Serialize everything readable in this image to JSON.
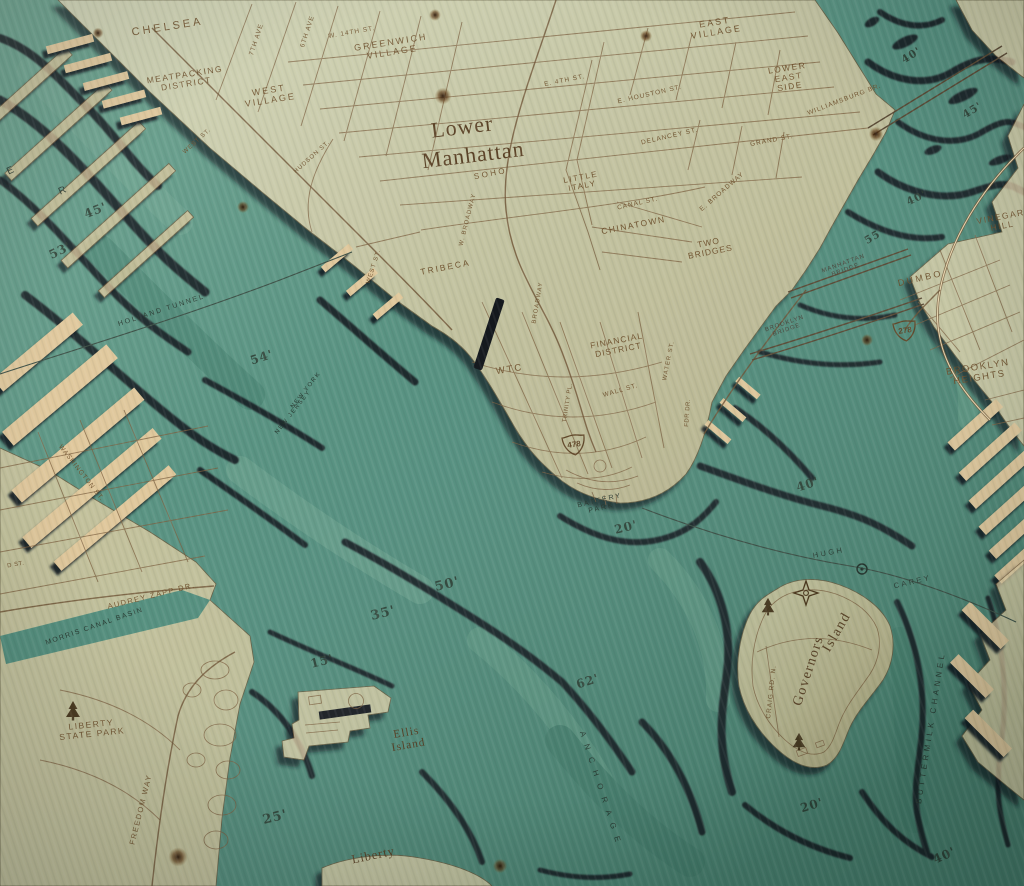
{
  "artwork": {
    "title": "Lower Manhattan",
    "subject": "3-D wood-carved nautical chart of Lower Manhattan and New York Harbor",
    "colors": {
      "wood_land": "#ead7ae",
      "water_teal": "#579181",
      "contour_shadow": "#131a20",
      "engraving": "#6b4c28"
    }
  },
  "shields": [
    {
      "id": "i478",
      "number": "478",
      "x": 574,
      "y": 444,
      "rot": -8
    },
    {
      "id": "i278",
      "number": "278",
      "x": 905,
      "y": 330,
      "rot": -8
    }
  ],
  "icons": [
    {
      "name": "tree-icon",
      "x": 73,
      "y": 710,
      "s": 1
    },
    {
      "name": "tree-icon",
      "x": 768,
      "y": 606,
      "s": 0.9
    },
    {
      "name": "tree-icon",
      "x": 799,
      "y": 741,
      "s": 0.9
    },
    {
      "name": "compass-star-icon",
      "x": 806,
      "y": 593,
      "s": 1
    },
    {
      "name": "tunnel-vent-icon",
      "x": 862,
      "y": 569,
      "s": 1
    },
    {
      "name": "wood-knot-icon",
      "x": 443,
      "y": 96,
      "s": 0.7
    },
    {
      "name": "wood-knot-icon",
      "x": 646,
      "y": 36,
      "s": 0.5
    },
    {
      "name": "wood-knot-icon",
      "x": 876,
      "y": 134,
      "s": 0.6
    },
    {
      "name": "wood-knot-icon",
      "x": 243,
      "y": 207,
      "s": 0.5
    },
    {
      "name": "wood-knot-icon",
      "x": 98,
      "y": 33,
      "s": 0.45
    },
    {
      "name": "wood-knot-icon",
      "x": 435,
      "y": 15,
      "s": 0.5
    },
    {
      "name": "wood-knot-icon",
      "x": 867,
      "y": 340,
      "s": 0.5
    },
    {
      "name": "wood-knot-icon",
      "x": 178,
      "y": 857,
      "s": 0.8
    },
    {
      "name": "wood-knot-icon",
      "x": 500,
      "y": 866,
      "s": 0.6
    }
  ],
  "labels": [
    {
      "id": "chelsea",
      "text": [
        "CHELSEA"
      ],
      "x": 168,
      "y": 30,
      "rot": -9,
      "size": 11,
      "sp": 3,
      "style": "land"
    },
    {
      "id": "seventh-ave",
      "text": [
        "7TH AVE"
      ],
      "x": 258,
      "y": 40,
      "rot": -72,
      "size": 6.5,
      "sp": 1,
      "style": "land"
    },
    {
      "id": "sixth-ave",
      "text": [
        "6TH AVE"
      ],
      "x": 309,
      "y": 32,
      "rot": -72,
      "size": 6.5,
      "sp": 1,
      "style": "land"
    },
    {
      "id": "w-14th-st",
      "text": [
        "W. 14TH ST."
      ],
      "x": 352,
      "y": 34,
      "rot": -10,
      "size": 6.5,
      "sp": 1,
      "style": "land"
    },
    {
      "id": "greenwich-village",
      "text": [
        "GREENWICH",
        "VILLAGE"
      ],
      "x": 392,
      "y": 50,
      "rot": -9,
      "size": 9,
      "sp": 2,
      "style": "land"
    },
    {
      "id": "meatpacking-district",
      "text": [
        "MEATPACKING",
        "DISTRICT"
      ],
      "x": 186,
      "y": 82,
      "rot": -9,
      "size": 8.5,
      "sp": 1.5,
      "style": "land"
    },
    {
      "id": "west-village",
      "text": [
        "WEST",
        "VILLAGE"
      ],
      "x": 270,
      "y": 98,
      "rot": -9,
      "size": 9,
      "sp": 2,
      "style": "land"
    },
    {
      "id": "east-village",
      "text": [
        "EAST",
        "VILLAGE"
      ],
      "x": 716,
      "y": 30,
      "rot": -9,
      "size": 9,
      "sp": 2,
      "style": "land"
    },
    {
      "id": "e-4th-st",
      "text": [
        "E. 4TH ST."
      ],
      "x": 565,
      "y": 82,
      "rot": -11,
      "size": 6.5,
      "sp": 1,
      "style": "land"
    },
    {
      "id": "e-houston-st",
      "text": [
        "E. HOUSTON ST."
      ],
      "x": 650,
      "y": 96,
      "rot": -13,
      "size": 6.5,
      "sp": 1,
      "style": "land"
    },
    {
      "id": "lower-east-side",
      "text": [
        "LOWER",
        "EAST",
        "SIDE"
      ],
      "x": 789,
      "y": 80,
      "rot": -9,
      "size": 8.5,
      "sp": 1.5,
      "style": "land"
    },
    {
      "id": "williamsburg-br",
      "text": [
        "WILLIAMSBURG BR."
      ],
      "x": 845,
      "y": 101,
      "rot": -21,
      "size": 6.5,
      "sp": 1,
      "style": "land"
    },
    {
      "id": "delancey-st",
      "text": [
        "DELANCEY ST."
      ],
      "x": 670,
      "y": 138,
      "rot": -13,
      "size": 6.5,
      "sp": 1,
      "style": "land"
    },
    {
      "id": "grand-st",
      "text": [
        "GRAND ST."
      ],
      "x": 772,
      "y": 142,
      "rot": -11,
      "size": 6.5,
      "sp": 1,
      "style": "land"
    },
    {
      "id": "west-st-upper",
      "text": [
        "WEST ST."
      ],
      "x": 198,
      "y": 142,
      "rot": -42,
      "size": 6,
      "sp": 1,
      "style": "land"
    },
    {
      "id": "hudson-st",
      "text": [
        "HUDSON ST."
      ],
      "x": 313,
      "y": 158,
      "rot": -42,
      "size": 6,
      "sp": 1,
      "style": "land"
    },
    {
      "id": "title-lower",
      "text": [
        "Lower"
      ],
      "x": 463,
      "y": 134,
      "rot": -7,
      "size": 22,
      "sp": 1,
      "style": "serif"
    },
    {
      "id": "title-manhattan",
      "text": [
        "Manhattan"
      ],
      "x": 474,
      "y": 162,
      "rot": -7,
      "size": 22,
      "sp": 1,
      "style": "serif"
    },
    {
      "id": "soho",
      "text": [
        "SOHO"
      ],
      "x": 491,
      "y": 176,
      "rot": -11,
      "size": 8,
      "sp": 2.5,
      "style": "land"
    },
    {
      "id": "little-italy",
      "text": [
        "LITTLE",
        "ITALY"
      ],
      "x": 582,
      "y": 184,
      "rot": -11,
      "size": 8,
      "sp": 1.5,
      "style": "land"
    },
    {
      "id": "canal-st",
      "text": [
        "CANAL ST."
      ],
      "x": 638,
      "y": 205,
      "rot": -13,
      "size": 6.5,
      "sp": 1,
      "style": "land"
    },
    {
      "id": "e-broadway",
      "text": [
        "E. BROADWAY"
      ],
      "x": 723,
      "y": 193,
      "rot": -41,
      "size": 6.5,
      "sp": 1,
      "style": "land"
    },
    {
      "id": "chinatown",
      "text": [
        "CHINATOWN"
      ],
      "x": 634,
      "y": 228,
      "rot": -11,
      "size": 8.5,
      "sp": 1.5,
      "style": "land"
    },
    {
      "id": "two-bridges",
      "text": [
        "TWO",
        "BRIDGES"
      ],
      "x": 710,
      "y": 250,
      "rot": -11,
      "size": 8.5,
      "sp": 1,
      "style": "land"
    },
    {
      "id": "tribeca",
      "text": [
        "TRIBECA"
      ],
      "x": 446,
      "y": 270,
      "rot": -11,
      "size": 8.5,
      "sp": 2,
      "style": "land"
    },
    {
      "id": "w-broadway",
      "text": [
        "W. BROADWAY"
      ],
      "x": 469,
      "y": 220,
      "rot": -76,
      "size": 6,
      "sp": 1,
      "style": "land"
    },
    {
      "id": "broadway",
      "text": [
        "BROADWAY"
      ],
      "x": 539,
      "y": 303,
      "rot": -80,
      "size": 6,
      "sp": 1,
      "style": "land"
    },
    {
      "id": "west-st-lower",
      "text": [
        "WEST ST."
      ],
      "x": 375,
      "y": 267,
      "rot": -72,
      "size": 6,
      "sp": 1,
      "style": "land"
    },
    {
      "id": "wtc",
      "text": [
        "WTC"
      ],
      "x": 510,
      "y": 372,
      "rot": -9,
      "size": 9.5,
      "sp": 2,
      "style": "land"
    },
    {
      "id": "financial-district",
      "text": [
        "FINANCIAL",
        "DISTRICT"
      ],
      "x": 618,
      "y": 348,
      "rot": -11,
      "size": 8.5,
      "sp": 1,
      "style": "land"
    },
    {
      "id": "wall-st",
      "text": [
        "WALL ST."
      ],
      "x": 621,
      "y": 392,
      "rot": -16,
      "size": 6.5,
      "sp": 1,
      "style": "land"
    },
    {
      "id": "water-st",
      "text": [
        "WATER ST."
      ],
      "x": 670,
      "y": 361,
      "rot": -79,
      "size": 6,
      "sp": 1,
      "style": "land"
    },
    {
      "id": "trinity-pl",
      "text": [
        "TRINITY PL."
      ],
      "x": 569,
      "y": 403,
      "rot": -81,
      "size": 6,
      "sp": 0.5,
      "style": "land"
    },
    {
      "id": "fdr-dr",
      "text": [
        "FDR DR."
      ],
      "x": 689,
      "y": 413,
      "rot": -86,
      "size": 6,
      "sp": 0.5,
      "style": "land"
    },
    {
      "id": "washington-st",
      "text": [
        "WASHINGTON ST."
      ],
      "x": 80,
      "y": 474,
      "rot": 52,
      "size": 6.5,
      "sp": 1,
      "style": "land"
    },
    {
      "id": "d-st-fragment",
      "text": [
        "D ST."
      ],
      "x": 16,
      "y": 566,
      "rot": -10,
      "size": 6,
      "sp": 0.5,
      "style": "land"
    },
    {
      "id": "audrey-zapp-dr",
      "text": [
        "AUDREY ZAPP DR."
      ],
      "x": 152,
      "y": 598,
      "rot": -14,
      "size": 7.5,
      "sp": 1.5,
      "style": "land"
    },
    {
      "id": "liberty-state-park",
      "text": [
        "LIBERTY",
        "STATE PARK"
      ],
      "x": 92,
      "y": 732,
      "rot": -6,
      "size": 8.5,
      "sp": 1.5,
      "style": "land"
    },
    {
      "id": "freedom-way",
      "text": [
        "FREEDOM WAY"
      ],
      "x": 143,
      "y": 810,
      "rot": -76,
      "size": 7.5,
      "sp": 1.5,
      "style": "land"
    },
    {
      "id": "craig-rd-n",
      "text": [
        "CRAIG RD. N."
      ],
      "x": 773,
      "y": 692,
      "rot": -84,
      "size": 6.5,
      "sp": 1,
      "style": "land"
    },
    {
      "id": "governors",
      "text": [
        "Governors"
      ],
      "x": 812,
      "y": 672,
      "rot": -72,
      "size": 14,
      "sp": 1.5,
      "style": "serif"
    },
    {
      "id": "island",
      "text": [
        "Island"
      ],
      "x": 840,
      "y": 634,
      "rot": -60,
      "size": 14,
      "sp": 1.5,
      "style": "serif"
    },
    {
      "id": "dumbo",
      "text": [
        "DUMBO"
      ],
      "x": 921,
      "y": 281,
      "rot": -13,
      "size": 9,
      "sp": 2.5,
      "style": "land"
    },
    {
      "id": "vinegar-hill",
      "text": [
        "VINEGAR",
        "HILL"
      ],
      "x": 1002,
      "y": 224,
      "rot": -11,
      "size": 8.5,
      "sp": 1.5,
      "style": "land"
    },
    {
      "id": "brooklyn-heights",
      "text": [
        "BROOKLYN",
        "HEIGHTS"
      ],
      "x": 979,
      "y": 375,
      "rot": -9,
      "size": 9.5,
      "sp": 1.5,
      "style": "land"
    },
    {
      "id": "manhattan-bridge",
      "text": [
        "MANHATTAN",
        "BRIDGE"
      ],
      "x": 845,
      "y": 268,
      "rot": -20,
      "size": 6,
      "sp": 1,
      "style": "bridge"
    },
    {
      "id": "brooklyn-bridge",
      "text": [
        "BROOKLYN",
        "BRIDGE"
      ],
      "x": 786,
      "y": 328,
      "rot": -19,
      "size": 6,
      "sp": 1,
      "style": "bridge"
    },
    {
      "id": "holland-tunnel",
      "text": [
        "HOLLAND TUNNEL"
      ],
      "x": 162,
      "y": 312,
      "rot": -18,
      "size": 7,
      "sp": 2,
      "style": "water"
    },
    {
      "id": "new-york",
      "text": [
        "NEW YORK"
      ],
      "x": 307,
      "y": 391,
      "rot": -52,
      "size": 6,
      "sp": 1.5,
      "style": "water"
    },
    {
      "id": "new-jersey",
      "text": [
        "NEW JERSEY"
      ],
      "x": 294,
      "y": 413,
      "rot": -52,
      "size": 6,
      "sp": 1.5,
      "style": "water"
    },
    {
      "id": "morris-canal-basin",
      "text": [
        "MORRIS CANAL BASIN"
      ],
      "x": 95,
      "y": 628,
      "rot": -19,
      "size": 7,
      "sp": 1.5,
      "style": "water"
    },
    {
      "id": "battery-park",
      "text": [
        "BATTERY",
        "PARK"
      ],
      "x": 601,
      "y": 506,
      "rot": -13,
      "size": 7,
      "sp": 2,
      "style": "water"
    },
    {
      "id": "hugh",
      "text": [
        "HUGH"
      ],
      "x": 829,
      "y": 555,
      "rot": -11,
      "size": 7.5,
      "sp": 2.5,
      "style": "water"
    },
    {
      "id": "carey",
      "text": [
        "CAREY"
      ],
      "x": 913,
      "y": 584,
      "rot": -13,
      "size": 7.5,
      "sp": 2.5,
      "style": "water"
    },
    {
      "id": "buttermilk-channel",
      "text": [
        "BUTTERMILK CHANNEL"
      ],
      "x": 933,
      "y": 728,
      "rot": -81,
      "size": 8,
      "sp": 3.5,
      "style": "water"
    },
    {
      "id": "anchorage",
      "text": [
        "ANCHORAGE"
      ],
      "x": 599,
      "y": 791,
      "rot": 72,
      "size": 8,
      "sp": 8,
      "style": "water"
    },
    {
      "id": "river-letter-e",
      "text": [
        "E"
      ],
      "x": 12,
      "y": 173,
      "rot": -25,
      "size": 10,
      "sp": 1,
      "style": "water"
    },
    {
      "id": "river-letter-r",
      "text": [
        "R"
      ],
      "x": 64,
      "y": 193,
      "rot": -25,
      "size": 10,
      "sp": 1,
      "style": "water"
    },
    {
      "id": "ellis-island",
      "text": [
        "Ellis",
        "Island"
      ],
      "x": 408,
      "y": 742,
      "rot": -10,
      "size": 11.5,
      "sp": 1,
      "style": "serif"
    },
    {
      "id": "liberty",
      "text": [
        "Liberty"
      ],
      "x": 374,
      "y": 859,
      "rot": -12,
      "size": 12.5,
      "sp": 1,
      "style": "serif"
    },
    {
      "id": "depth-45-hudson",
      "text": [
        "45'"
      ],
      "x": 97,
      "y": 214,
      "rot": -22,
      "size": 12,
      "sp": 1,
      "style": "depth"
    },
    {
      "id": "depth-53-hudson",
      "text": [
        "53'"
      ],
      "x": 62,
      "y": 254,
      "rot": -26,
      "size": 12,
      "sp": 1,
      "style": "depth"
    },
    {
      "id": "depth-54-hudson",
      "text": [
        "54'"
      ],
      "x": 263,
      "y": 361,
      "rot": -18,
      "size": 12,
      "sp": 1,
      "style": "depth"
    },
    {
      "id": "depth-40-eastriver-top",
      "text": [
        "40'"
      ],
      "x": 913,
      "y": 58,
      "rot": -32,
      "size": 10.5,
      "sp": 1,
      "style": "depth"
    },
    {
      "id": "depth-45-eastriver",
      "text": [
        "45'"
      ],
      "x": 974,
      "y": 113,
      "rot": -32,
      "size": 10.5,
      "sp": 1,
      "style": "depth"
    },
    {
      "id": "depth-40-eastriver-mid",
      "text": [
        "40'"
      ],
      "x": 918,
      "y": 201,
      "rot": -26,
      "size": 10.5,
      "sp": 1,
      "style": "depth"
    },
    {
      "id": "depth-55-eastriver",
      "text": [
        "55'"
      ],
      "x": 876,
      "y": 239,
      "rot": -30,
      "size": 10.5,
      "sp": 1,
      "style": "depth"
    },
    {
      "id": "depth-40-eastriver-low",
      "text": [
        "40'"
      ],
      "x": 809,
      "y": 488,
      "rot": -18,
      "size": 12,
      "sp": 1,
      "style": "depth"
    },
    {
      "id": "depth-20-battery",
      "text": [
        "20'"
      ],
      "x": 627,
      "y": 531,
      "rot": -14,
      "size": 12,
      "sp": 1,
      "style": "depth"
    },
    {
      "id": "depth-50-harbor",
      "text": [
        "50'"
      ],
      "x": 448,
      "y": 588,
      "rot": -14,
      "size": 13,
      "sp": 1,
      "style": "depth"
    },
    {
      "id": "depth-35-harbor",
      "text": [
        "35'"
      ],
      "x": 384,
      "y": 617,
      "rot": -14,
      "size": 13,
      "sp": 1,
      "style": "depth"
    },
    {
      "id": "depth-15-harbor",
      "text": [
        "15'"
      ],
      "x": 323,
      "y": 665,
      "rot": -14,
      "size": 12,
      "sp": 1,
      "style": "depth"
    },
    {
      "id": "depth-62-anchorage",
      "text": [
        "62'"
      ],
      "x": 589,
      "y": 685,
      "rot": -18,
      "size": 12,
      "sp": 1,
      "style": "depth"
    },
    {
      "id": "depth-25-harbor",
      "text": [
        "25'"
      ],
      "x": 276,
      "y": 821,
      "rot": -14,
      "size": 13,
      "sp": 1,
      "style": "depth"
    },
    {
      "id": "depth-20-buttermilk",
      "text": [
        "20'"
      ],
      "x": 813,
      "y": 809,
      "rot": -17,
      "size": 12,
      "sp": 1,
      "style": "depth"
    },
    {
      "id": "depth-40-buttermilk",
      "text": [
        "40'"
      ],
      "x": 946,
      "y": 859,
      "rot": -24,
      "size": 12,
      "sp": 1,
      "style": "depth"
    }
  ]
}
